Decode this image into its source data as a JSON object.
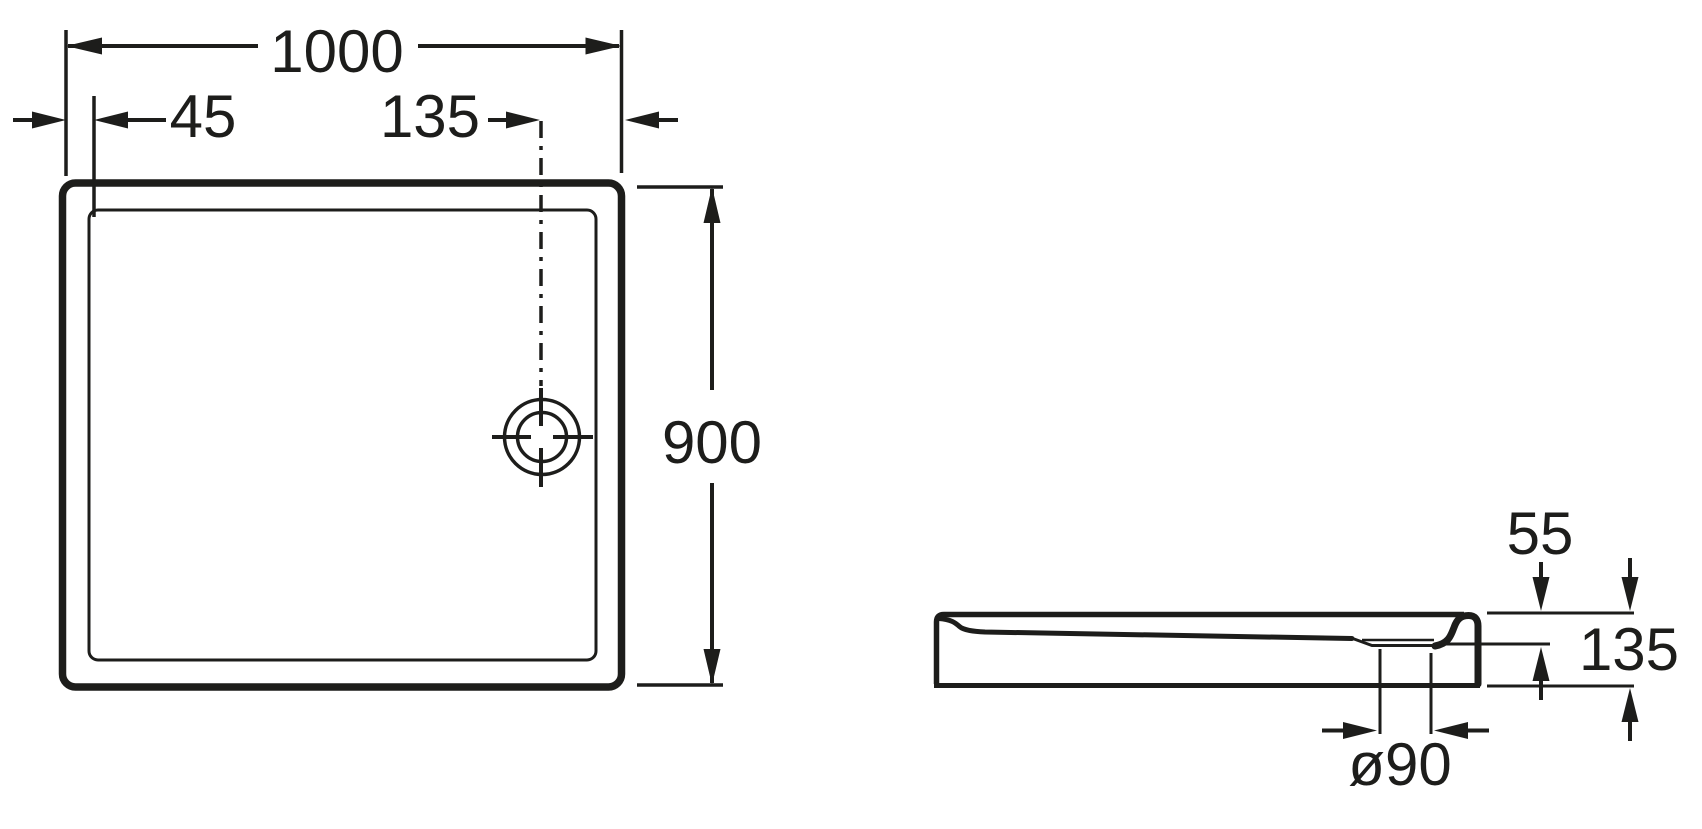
{
  "drawing": {
    "background_color": "#ffffff",
    "line_color": "#1d1d1b",
    "views": {
      "plan": {
        "dims": {
          "width": "1000",
          "rim_inset": "45",
          "drain_offset": "135",
          "depth": "900"
        }
      },
      "side": {
        "dims": {
          "basin_depth": "55",
          "height": "135",
          "drain_diameter": "ø90"
        }
      }
    }
  }
}
